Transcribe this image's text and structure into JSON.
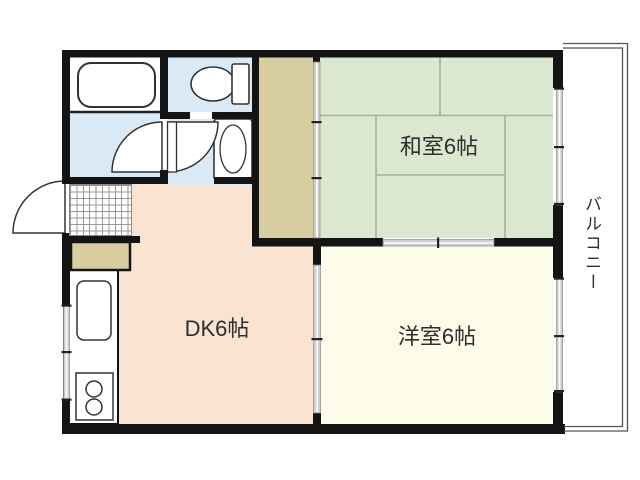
{
  "page": {
    "type": "apartment-floor-plan"
  },
  "rooms": {
    "japanese_room": {
      "label": "和室6帖",
      "size_mats": 6
    },
    "western_room": {
      "label": "洋室6帖",
      "size_mats": 6
    },
    "dining_kitchen": {
      "label": "DK6帖",
      "size_mats": 6
    },
    "balcony": {
      "label": "バルコニー"
    }
  },
  "fixtures": {
    "bathtub": "bathtub",
    "toilet": "toilet",
    "washbasin": "washbasin",
    "kitchen_sink": "kitchen-sink",
    "stove": "two-burner-stove",
    "shoe_cabinet": "shoe-cabinet",
    "entrance_tile": "genkan-tile",
    "closet": "closet"
  },
  "colors": {
    "wall": "#141414",
    "japanese_room_floor": "#dbe8cf",
    "western_room_floor": "#fdfce9",
    "dining_kitchen_floor": "#fae3d1",
    "wet_area_floor": "#d9eaf6",
    "closet_fill": "#d8cda1",
    "tatami_line": "#a3b296",
    "fixture_outline": "#333333",
    "window_glass": "#cfcfcf"
  }
}
